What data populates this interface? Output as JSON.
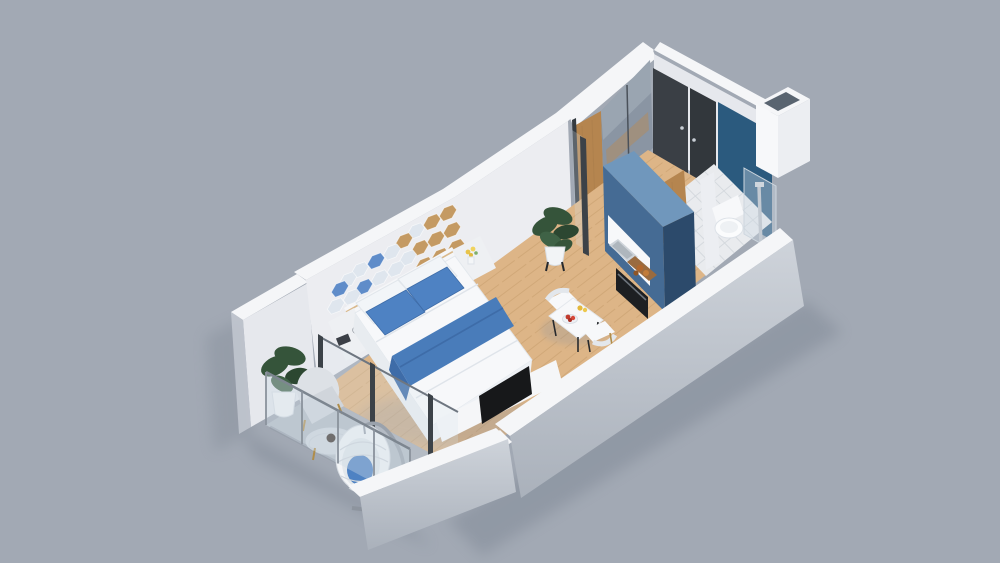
{
  "scene": {
    "type": "3d-isometric-floorplan-render",
    "description": "Photoreal isometric 3D floor plan of a studio apartment with bedroom, kitchenette, bathroom, entry hall and balcony, on a plain gray backdrop",
    "background_color": "#a2a9b4",
    "palette": {
      "wall_white": "#ecedf1",
      "wall_top_band": "#f5f6f8",
      "exterior_gray": "#c6cbd3",
      "wood_floor": "#ddb587",
      "wood_plank_line": "#c79e6d",
      "wood_accent": "#b5854f",
      "balcony_floor": "#b4bbc4",
      "tile_floor": "#e9ebee",
      "kitchen_blue_top": "#7097bc",
      "kitchen_blue_front": "#456b94",
      "kitchen_blue_side": "#2c4a6b",
      "accent_wall_blue": "#2b5a7e",
      "bed_blue": "#4e82c3",
      "throw_blue": "#497cba",
      "dark_door": "#3a3f45",
      "mirror_gray": "#8a95a3",
      "tv_black": "#17181a",
      "plant_green": "#35543a",
      "chrome_gray": "#c3cad2"
    },
    "rooms": [
      {
        "name": "bedroom-living",
        "features": [
          "double-bed",
          "headboard-nightstands",
          "hexagon-wall-decor",
          "tv-on-low-cabinet",
          "wood-floor"
        ]
      },
      {
        "name": "kitchenette",
        "features": [
          "blue-cabinet-unit",
          "sink",
          "oven",
          "cutting-board",
          "dining-table-for-two"
        ]
      },
      {
        "name": "bathroom",
        "features": [
          "blue-accent-wall",
          "toilet",
          "glass-shower",
          "tile-floor"
        ]
      },
      {
        "name": "entry-hall",
        "features": [
          "mirrored-sliding-wardrobe",
          "dark-entry-doors",
          "wood-floor"
        ]
      },
      {
        "name": "balcony",
        "features": [
          "glass-railing",
          "hanging-egg-chair",
          "armchair",
          "round-glass-table",
          "potted-plant"
        ]
      }
    ],
    "objects": [
      "double-bed",
      "blue-pillows",
      "blue-throw-blanket",
      "nightstand-left",
      "nightstand-right",
      "hexagon-mirror-decor",
      "tv",
      "tv-cabinet",
      "dining-table",
      "dining-chairs",
      "fruit-bowl",
      "kitchen-unit",
      "kitchen-sink",
      "oven",
      "potted-plant-hall",
      "wardrobe-mirror-doors",
      "entry-doors",
      "duct-shaft",
      "toilet",
      "shower-column",
      "shower-glass",
      "accent-wall",
      "balcony-plant",
      "armchair",
      "coffee-table",
      "hanging-egg-chair",
      "glass-railing",
      "parapet"
    ]
  }
}
